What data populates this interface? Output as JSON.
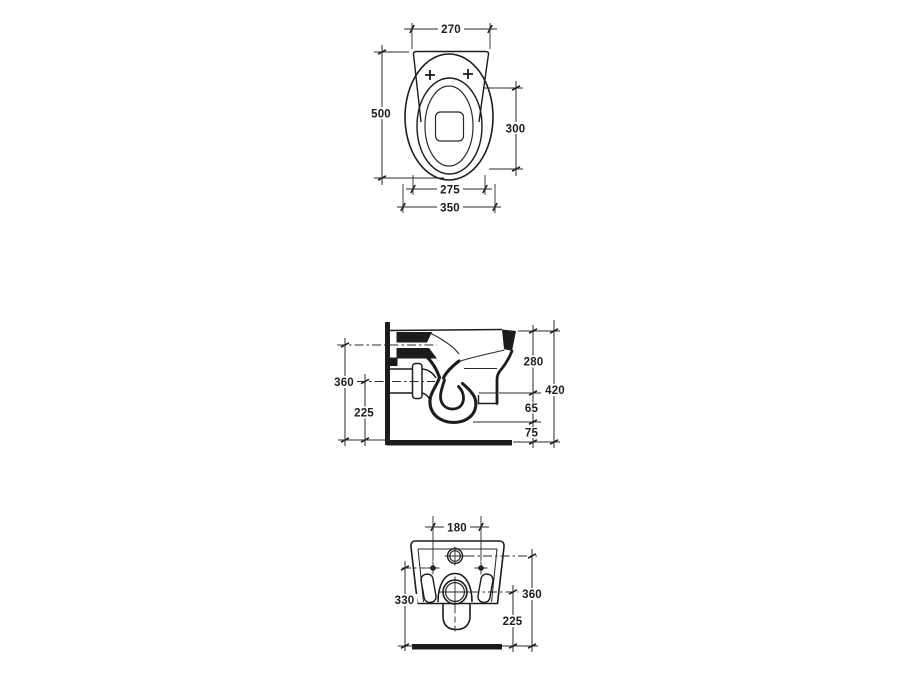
{
  "drawing": {
    "line_color": "#1c1c1c",
    "background_color": "#ffffff",
    "top_view": {
      "dims": {
        "back_width": "270",
        "total_depth": "500",
        "bowl_opening_length": "300",
        "seat_width": "275",
        "total_width": "350"
      }
    },
    "side_view": {
      "dims": {
        "inlet_height": "360",
        "outlet_height": "225",
        "top_to_skirt": "280",
        "total_height": "420",
        "skirt_gap": "65",
        "trap_clearance": "75"
      }
    },
    "rear_view": {
      "dims": {
        "fixing_hole_centres": "180",
        "fixing_hole_height": "330",
        "inlet_height": "360",
        "outlet_height": "225"
      }
    }
  }
}
